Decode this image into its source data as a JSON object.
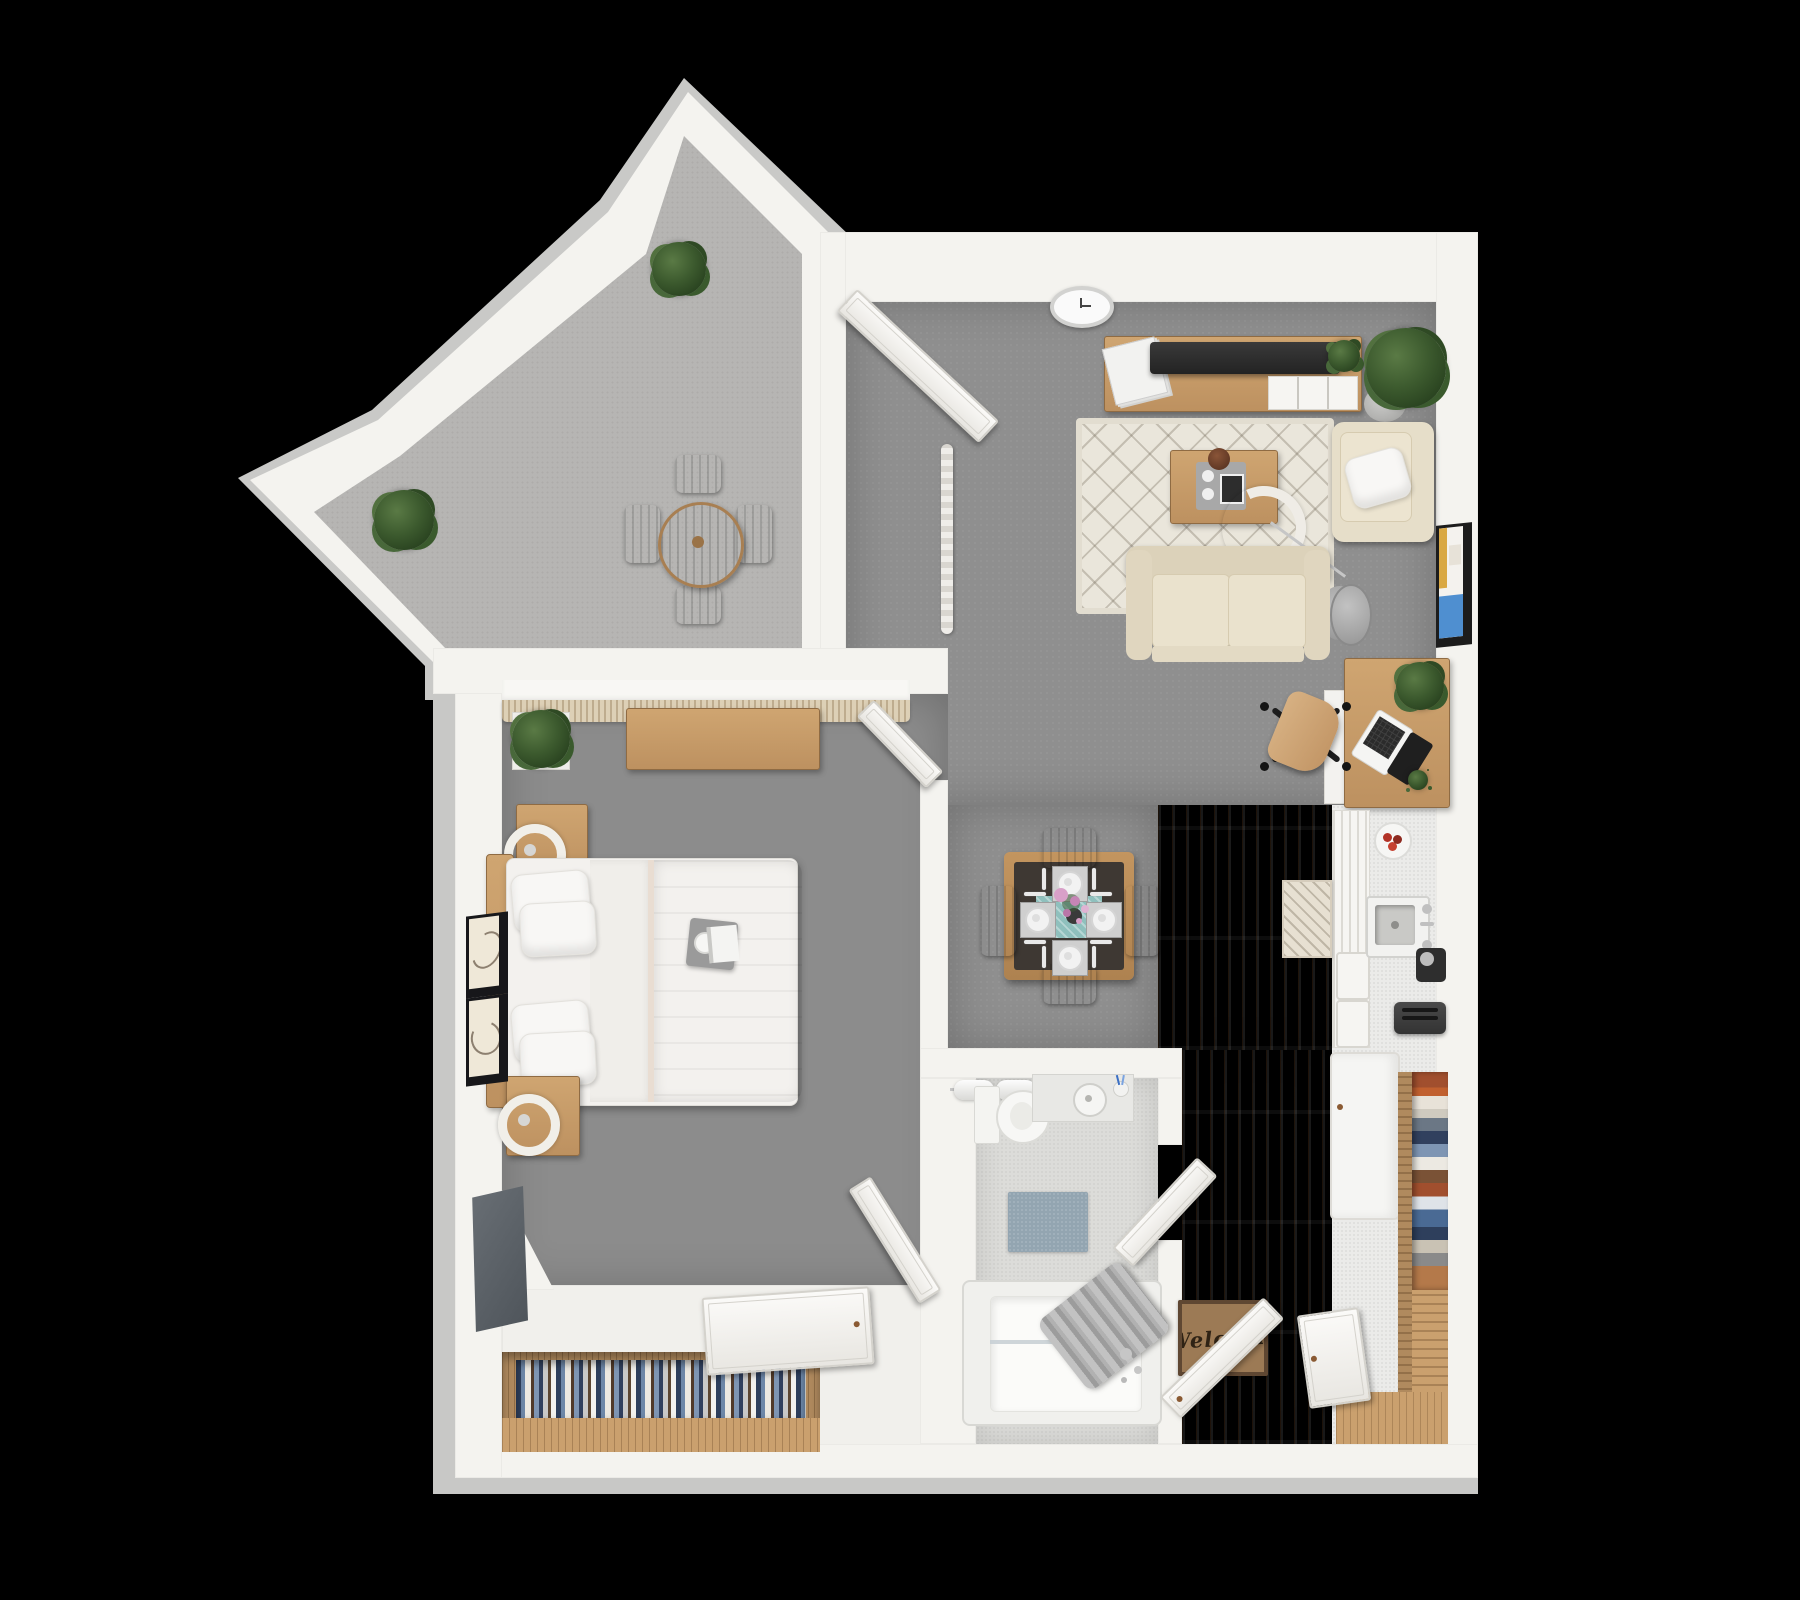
{
  "scene": {
    "title": "3D apartment floor plan, top-down view (1 bed / 1 bath with balcony)",
    "background": "#000000",
    "welcome_mat_text": "Welcome"
  },
  "palette": {
    "wall": "#f4f3ef",
    "wall_edge": "#c8c8c6",
    "balcony_floor": "#b6b5b3",
    "living_floor": "#8f8f8f",
    "bedroom_floor": "#8c8c8c",
    "bathroom_floor": "#dcdcd9",
    "wood_floor": "#cda77d",
    "counter": "#ebebe9",
    "furniture_wood": "#c79e6b",
    "sofa_cream": "#e6dec9",
    "duvet_tan": "#d6c4b5",
    "rug_cream": "#eae6db",
    "teal_runner": "#8fc0bd",
    "bath_mat_blue": "#93a5b1",
    "plant_green": "#3c5a2e",
    "tv_black": "#2b2b2b",
    "welcome_mat_brown": "#9c7a55"
  },
  "labels": {
    "floor_plan": "Apartment 3D floor plan",
    "balcony": "Balcony",
    "living_room": "Living room",
    "dining_area": "Dining area",
    "kitchen": "Kitchen",
    "bedroom": "Bedroom",
    "bathroom": "Bathroom",
    "entry": "Entry hallway",
    "patio_table": "Round patio table",
    "patio_chair": "Patio chair",
    "potted_plant": "Potted plant",
    "wall_clock": "Wall clock",
    "tv_console": "TV media console with magazines",
    "television": "Television",
    "area_rug": "Patterned cream area rug",
    "coffee_table": "Coffee table with tray",
    "arc_lamp": "Arc floor lamp",
    "sofa": "Loveseat sofa",
    "armchair": "Armchair with throw pillow",
    "side_table": "Round side table",
    "wall_art": "Framed wall art",
    "desk": "Desk with laptop",
    "laptop": "Laptop",
    "office_chair": "Office chair",
    "dining_table": "Dining table set for four",
    "dining_chair": "Dining chair",
    "kitchen_cabinets": "Kitchen cabinets",
    "kitchen_sink": "Kitchen sink",
    "fruit_plate": "Plate of fruit",
    "coffee_maker": "Coffee maker",
    "toaster": "Toaster",
    "fridge": "Refrigerator",
    "kitchen_rug": "Kitchen runner rug",
    "hall_closet": "Hall closet shelves with folded clothes",
    "window_curtain": "Bedroom window with curtain valance",
    "dresser": "Dresser",
    "bed": "Queen bed with tan duvet",
    "nightstand": "Nightstand with lamp",
    "bedroom_tv": "Wall-mounted TV",
    "bedroom_closet": "Closet with hanging clothes",
    "toilet": "Toilet",
    "towel_bar": "Towel bar with rolled towels",
    "vanity": "Bathroom vanity sink",
    "bath_mat": "Bath mat",
    "bathtub": "Bathtub with shower curtain",
    "welcome_mat": "Welcome door mat",
    "door_open": "Open door",
    "hanging_blind": "Hanging blind"
  },
  "rooms": [
    {
      "name": "Balcony",
      "floor": "light gray outdoor carpet",
      "items": [
        "round patio table",
        "4 patio chairs",
        "2 potted plants"
      ]
    },
    {
      "name": "Living room",
      "floor": "gray carpet",
      "items": [
        "TV console with television and magazines",
        "tall potted plant",
        "wall clock",
        "patterned cream rug",
        "coffee table with tray",
        "arc floor lamp",
        "loveseat sofa",
        "armchair with pillow",
        "round side table",
        "framed wall art",
        "desk with laptop and plants",
        "office chair"
      ]
    },
    {
      "name": "Dining area",
      "floor": "gray carpet",
      "items": [
        "wood dining table with dark top",
        "4 place settings with plates and cutlery",
        "teal runner with pink flowers",
        "4 wooden chairs"
      ]
    },
    {
      "name": "Kitchen",
      "floor": "wood planks",
      "items": [
        "white counter with sink and faucet",
        "slatted cabinet fronts and drawers",
        "plate of fruit",
        "coffee maker",
        "toaster",
        "refrigerator",
        "patterned runner rug"
      ]
    },
    {
      "name": "Bedroom",
      "floor": "gray carpet",
      "items": [
        "queen bed with white pillows and tan duvet",
        "2 nightstands with ring lamps",
        "long wood dresser under curtained window",
        "potted plant",
        "2 framed artworks",
        "wall TV",
        "bottom closet with hanging clothes",
        "open doors"
      ]
    },
    {
      "name": "Bathroom",
      "floor": "light speckled tile",
      "items": [
        "toilet",
        "towel bar with 2 rolled towels",
        "vanity with round sink and toothbrush cup",
        "blue-gray bath mat",
        "bathtub with gray shower curtain and faucet"
      ]
    },
    {
      "name": "Entry",
      "floor": "wood planks",
      "items": [
        "Welcome door mat",
        "open entry door",
        "closet with stacked clothes and shoes"
      ]
    }
  ]
}
